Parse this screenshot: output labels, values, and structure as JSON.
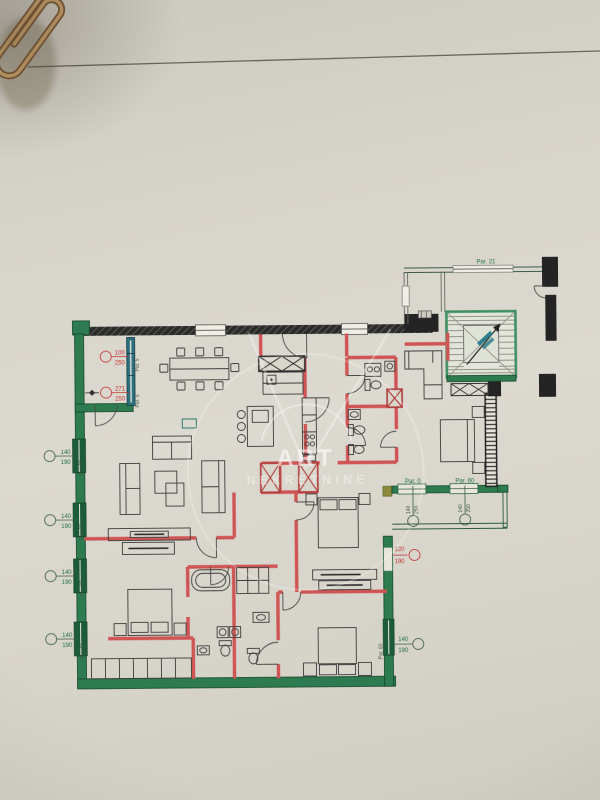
{
  "watermark": {
    "title": "ART",
    "subtitle": "NEKRETNINE"
  },
  "plan_labels": {
    "parapet_top": "Par. 21",
    "terrace_section_a": "Par. 0",
    "terrace_section_b": "Par. 60",
    "wall_left": "Par. 60",
    "bay_wall": "Par. 5"
  },
  "dimensions": {
    "left_windows": [
      {
        "width": "140",
        "height": "190"
      },
      {
        "width": "140",
        "height": "190"
      },
      {
        "width": "140",
        "height": "190"
      },
      {
        "width": "140",
        "height": "190"
      }
    ],
    "right_window": {
      "width": "140",
      "height": "190"
    },
    "bay_openings": [
      {
        "width": "100",
        "height": "250"
      },
      {
        "width": "271",
        "height": "250"
      }
    ],
    "terrace_windows": [
      {
        "width": "140",
        "height": "250"
      },
      {
        "width": "140",
        "height": "250"
      }
    ],
    "terrace_door": {
      "width": "120",
      "height": "190"
    }
  },
  "colors": {
    "exterior_wall": "#2d7b4e",
    "interior_wall": "#cf5454",
    "structural_wall": "#242424",
    "bay_wall": "#2d6f7e",
    "annotation_green": "#1f6e42",
    "annotation_red": "#c23434",
    "stair_note": "#2f7f8e",
    "paper": "#d8d5cb",
    "watermark": "#ffffff"
  }
}
